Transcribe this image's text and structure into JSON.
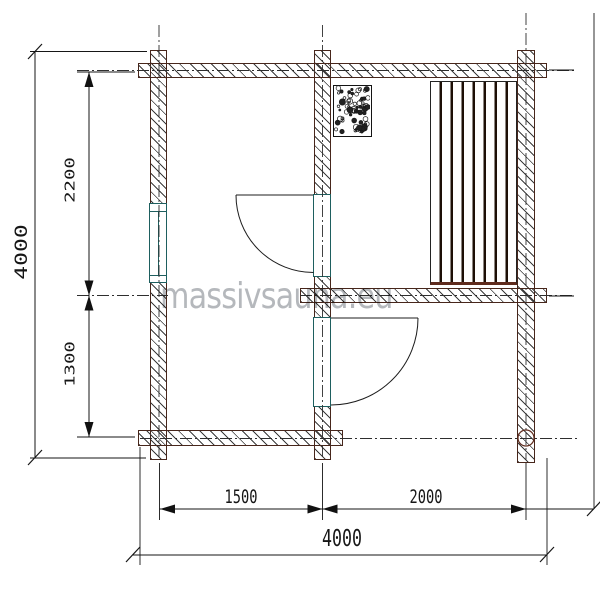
{
  "title": "sauna-floor-plan",
  "watermark": "massivsauna.eu",
  "dimensions": {
    "overall_height": "4000",
    "overall_width": "4000",
    "upper_room_height": "2200",
    "lower_room_height": "1300",
    "left_room_width": "1500",
    "right_room_width": "2000"
  },
  "colors": {
    "wall_outline": "#47261b",
    "hatch": "#3c3c3c",
    "frame_teal": "#1e5f5f",
    "dimension_lines": "#161616",
    "watermark_gray": "#b5b8bc",
    "log_accent_maroon": "#5f2b1d",
    "bench_slat": "#1d0f06"
  },
  "features": {
    "stove": "stone-filled sauna heater",
    "bench": "slatted sauna bench",
    "window": "window in left wall",
    "doors": "two swing doors in middle wall"
  }
}
